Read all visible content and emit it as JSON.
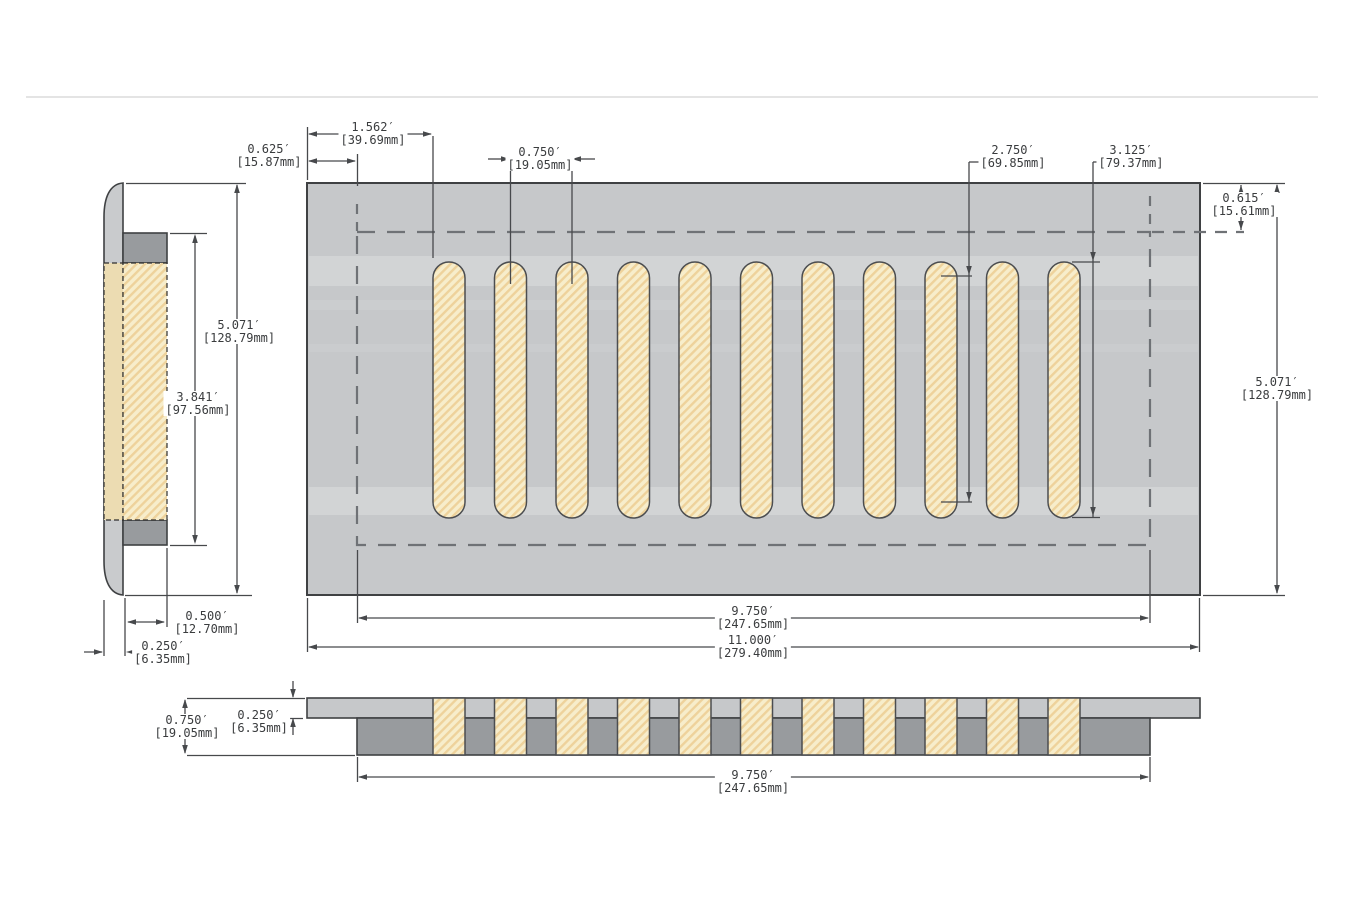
{
  "drawing": {
    "description": "Vent cover technical drawing, three views",
    "slot_count": 11,
    "colors": {
      "panel": "#c6c8ca",
      "body_dark": "#989b9e",
      "shell_light": "#c9cbcd",
      "slot_fill": "#f7edcb",
      "slot_hatch": "#eed29b",
      "side_slot_plain": "#ecdcb2",
      "outline": "#3f4143",
      "dim_line": "#47494c",
      "dashed_line": "#6f7276"
    },
    "dims": {
      "slot_offset": {
        "in": "1.562′",
        "mm": "[39.69mm]"
      },
      "margin_left": {
        "in": "0.625′",
        "mm": "[15.87mm]"
      },
      "slot_pitch": {
        "in": "0.750′",
        "mm": "[19.05mm]"
      },
      "slot_inner_height": {
        "in": "2.750′",
        "mm": "[69.85mm]"
      },
      "slot_height": {
        "in": "3.125′",
        "mm": "[79.37mm]"
      },
      "border_top": {
        "in": "0.615′",
        "mm": "[15.61mm]"
      },
      "overall_height": {
        "in": "5.071′",
        "mm": "[128.79mm]"
      },
      "overall_height_side": {
        "in": "5.071′",
        "mm": "[128.79mm]"
      },
      "opening_height": {
        "in": "3.841′",
        "mm": "[97.56mm]"
      },
      "frame_depth": {
        "in": "0.500′",
        "mm": "[12.70mm]"
      },
      "face_thickness": {
        "in": "0.250′",
        "mm": "[6.35mm]"
      },
      "opening_width": {
        "in": "9.750′",
        "mm": "[247.65mm]"
      },
      "overall_width": {
        "in": "11.000′",
        "mm": "[279.40mm]"
      },
      "section_depth": {
        "in": "0.750′",
        "mm": "[19.05mm]"
      },
      "plate_thickness": {
        "in": "0.250′",
        "mm": "[6.35mm]"
      },
      "section_opening_width": {
        "in": "9.750′",
        "mm": "[247.65mm]"
      }
    }
  }
}
